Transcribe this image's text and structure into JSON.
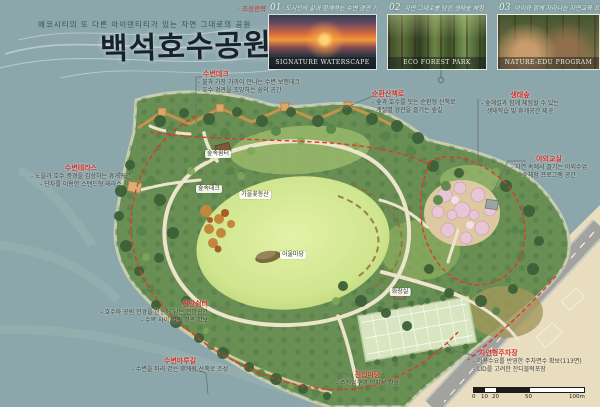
{
  "header": {
    "subtitle": "에코시티의 또 다른 아이덴티티가 있는 자연 그대로의 공원",
    "title": "백석호수공원",
    "strategy_label": "· 조성전략"
  },
  "photos": [
    {
      "number": "01",
      "heading": "도시민의 삶과 함께하는 수변 경관 거점",
      "caption": "SIGNATURE WATERSCAPE"
    },
    {
      "number": "02",
      "heading": "자연 그대로를 담은 생태숲 체험 공간",
      "caption": "ECO FOREST PARK"
    },
    {
      "number": "03",
      "heading": "아이와 함께 자라나는 자연교육 프로그램",
      "caption": "NATURE-EDU PROGRAM"
    }
  ],
  "callouts": {
    "deck": {
      "title": "수변데크",
      "lines": [
        "- 물과 가장 가까이 만나는 수변 보행데크",
        "- 호수 경관을 조망하는 쉼의 공간"
      ]
    },
    "terrace": {
      "title": "수변테라스",
      "lines": [
        "- 노을과 호수 풍경을 감상하는 휴게공간",
        "- 단차를 이용한 스탠드형 테라스"
      ]
    },
    "loop": {
      "title": "순환산책로",
      "lines": [
        "- 숲과 호수를 잇는 순환형 산책로",
        "- 계절별 경관을 즐기는 숲길"
      ]
    },
    "eco": {
      "title": "생태숲",
      "lines": [
        "- 숲해설과 함께 체험할 수 있는",
        "생태학습 및 휴게공간 제공"
      ]
    },
    "class": {
      "title": "야외교실",
      "lines": [
        "- 자연 속에서 즐기는 야외수업",
        "숲체험 프로그램 공간"
      ]
    },
    "view": {
      "title": "전망쉼터",
      "lines": [
        "- 호수와 공원 전경을 한눈에 담는 전망공간",
        "- 수목 사이 열린 경관 확보"
      ]
    },
    "maru": {
      "title": "수변마루길",
      "lines": [
        "- 수변을 따라 걷는 휴게형 산책로 조성"
      ]
    },
    "entry": {
      "title": "진입마당",
      "lines": [
        "- 주진입구역 인지성 강화"
      ]
    },
    "parking": {
      "title": "자연형주차장",
      "lines": [
        "- 이용수요를 반영한 주차면수 확보(113면)",
        "- LID를 고려한 잔디블럭포장"
      ]
    }
  },
  "map_labels": {
    "forest_rest": "숲속쉼터",
    "forest_deck": "숲속데크",
    "autumn_garden": "가을꽃동산",
    "oul_madang": "어울마당",
    "toilet": "화장실"
  },
  "scalebar": {
    "ticks": [
      "0",
      "10",
      "20",
      "50",
      "100m"
    ]
  },
  "colors": {
    "water": "#8ca7ab",
    "accent_red": "#d03127",
    "lawn": "#cfe592",
    "forest": "#47703f"
  }
}
